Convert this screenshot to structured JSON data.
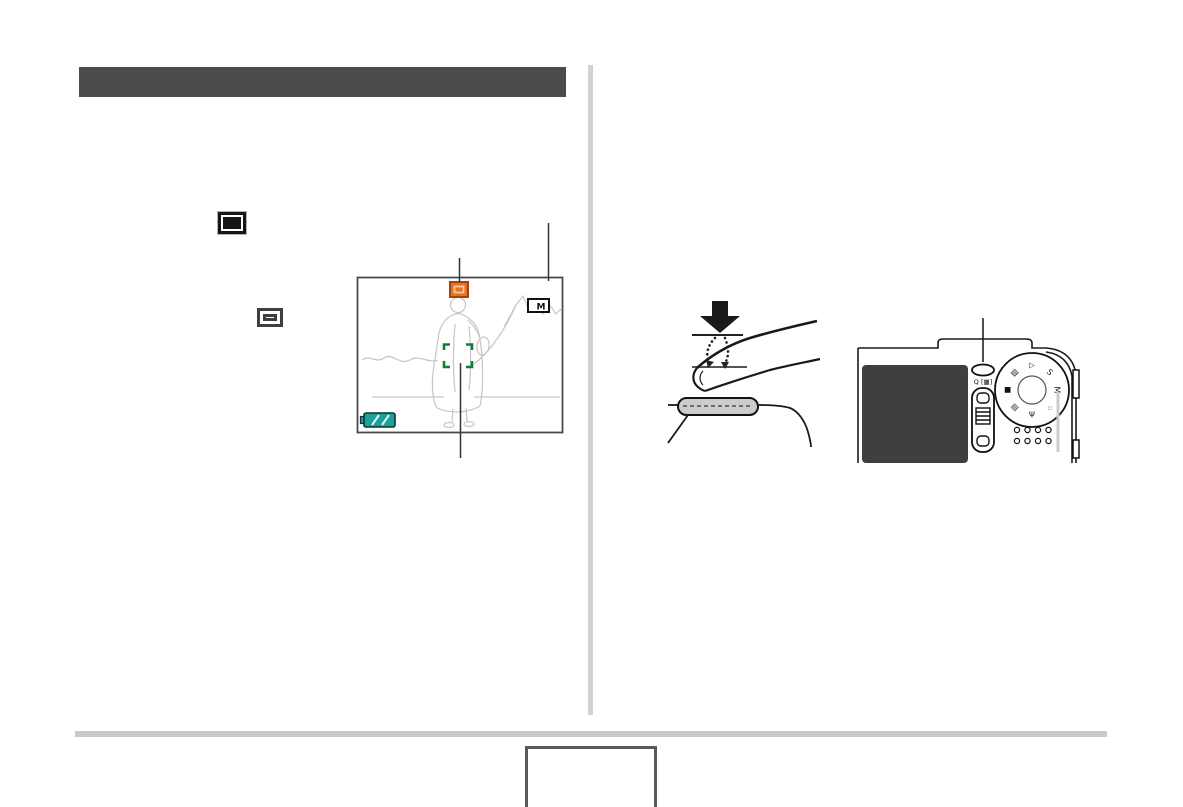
{
  "header": {
    "bar_color": "#4b4b4b"
  },
  "layout_colors": {
    "divider": "#d2d2d2",
    "footer_rule": "#c9c9c9"
  },
  "left_column": {
    "filled_frame_icon": "focus-frame-filled-icon",
    "outline_frame_icon": "focus-frame-outline-icon"
  },
  "monitor_illustration": {
    "focus_mode_icon_color": "#e2761f",
    "memory_indicator_label": "M",
    "focus_frame_color": "#0c8038",
    "battery_icon_color": "#1ba39b"
  },
  "shutter_illustration": {
    "press_arrow_color": "#1a1a1a",
    "button_fill": "#cccccc"
  },
  "camera_back_illustration": {
    "zoom_rocker_label": "Q [▦]",
    "lcd_fill": "#3f3f3f",
    "mode_dial_icons": [
      {
        "glyph": "▧"
      },
      {
        "glyph": "▷"
      },
      {
        "glyph": "S"
      },
      {
        "glyph": "M"
      },
      {
        "glyph": "⁘"
      },
      {
        "glyph": "Ψ"
      },
      {
        "glyph": "▤"
      },
      {
        "glyph": "■"
      }
    ]
  },
  "footer": {
    "page_number_box_text": ""
  }
}
